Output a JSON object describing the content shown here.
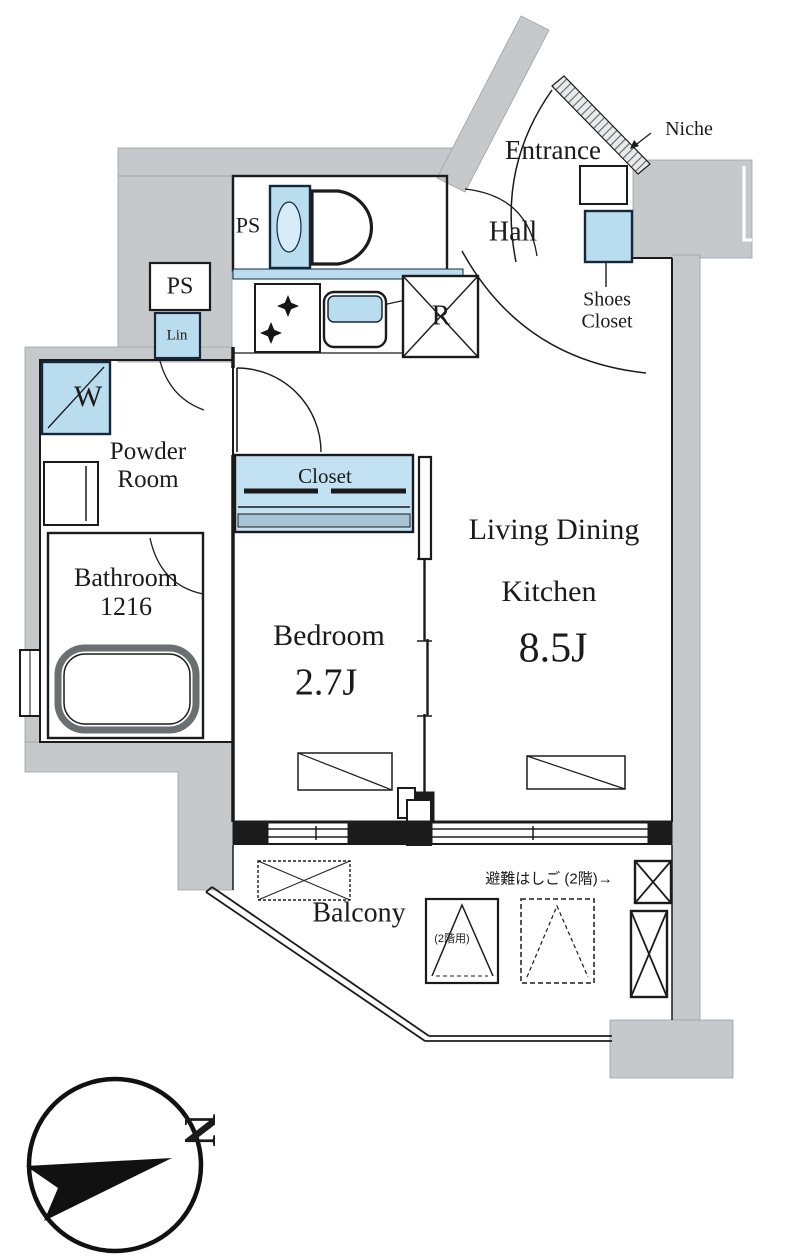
{
  "plan": {
    "type": "apartment-floor-plan",
    "colors": {
      "wall_gray": "#c6c9cb",
      "fixture_blue": "#b9dcef",
      "closet_blue": "#c2e2f3",
      "fixture_border": "#14283c",
      "line": "#1b1b1b",
      "tub_gray": "#6a6f72"
    },
    "labels": {
      "entrance": "Entrance",
      "niche": "Niche",
      "hall": "Hall",
      "shoes_closet": "Shoes\nCloset",
      "ps_toilet": "PS",
      "ps_shaft": "PS",
      "linen": "Lin",
      "washer": "W",
      "powder_room": "Powder\nRoom",
      "bathroom": "Bathroom\n1216",
      "closet": "Closet",
      "bedroom_name": "Bedroom",
      "bedroom_size": "2.7J",
      "ldk_line1": "Living Dining",
      "ldk_line2": "Kitchen",
      "ldk_size": "8.5J",
      "balcony": "Balcony",
      "refrigerator": "R",
      "evac_ladder_note": "避難はしご (2階)→",
      "evac_hatch_note": "(2階用)",
      "compass_north": "N"
    }
  }
}
